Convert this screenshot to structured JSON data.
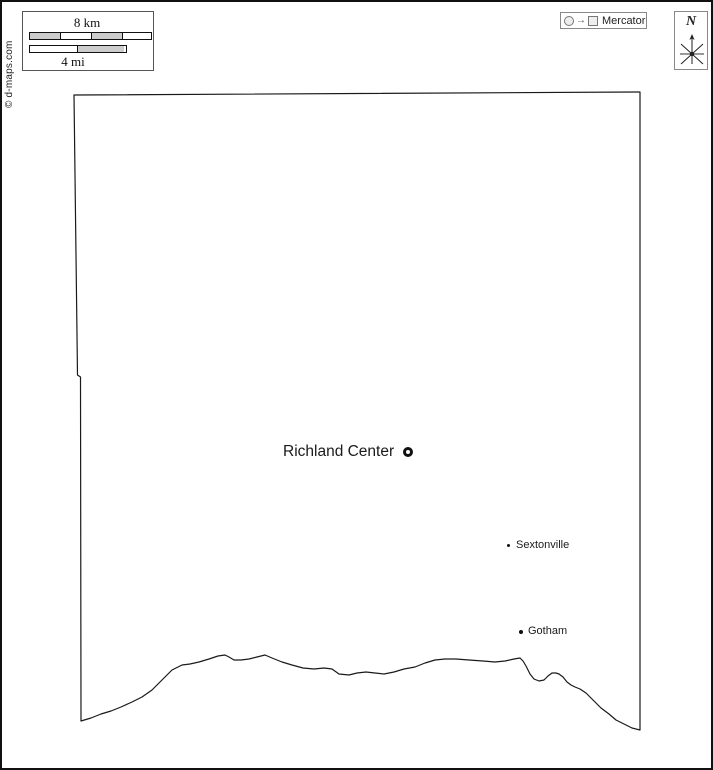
{
  "copyright": "© d-maps.com",
  "scale_box": {
    "km_label": "8 km",
    "mi_label": "4 mi"
  },
  "projection_box": {
    "label": "Mercator"
  },
  "compass_box": {
    "label": "N"
  },
  "map": {
    "places": [
      {
        "name": "Richland Center",
        "marker": "ring"
      },
      {
        "name": "Sextonville",
        "marker": "dot"
      },
      {
        "name": "Gotham",
        "marker": "dot"
      }
    ]
  },
  "colors": {
    "outline": "#1a1a1a",
    "scale_segment_gray": "#cccccc",
    "box_border_gray": "#888888",
    "background": "#ffffff"
  }
}
